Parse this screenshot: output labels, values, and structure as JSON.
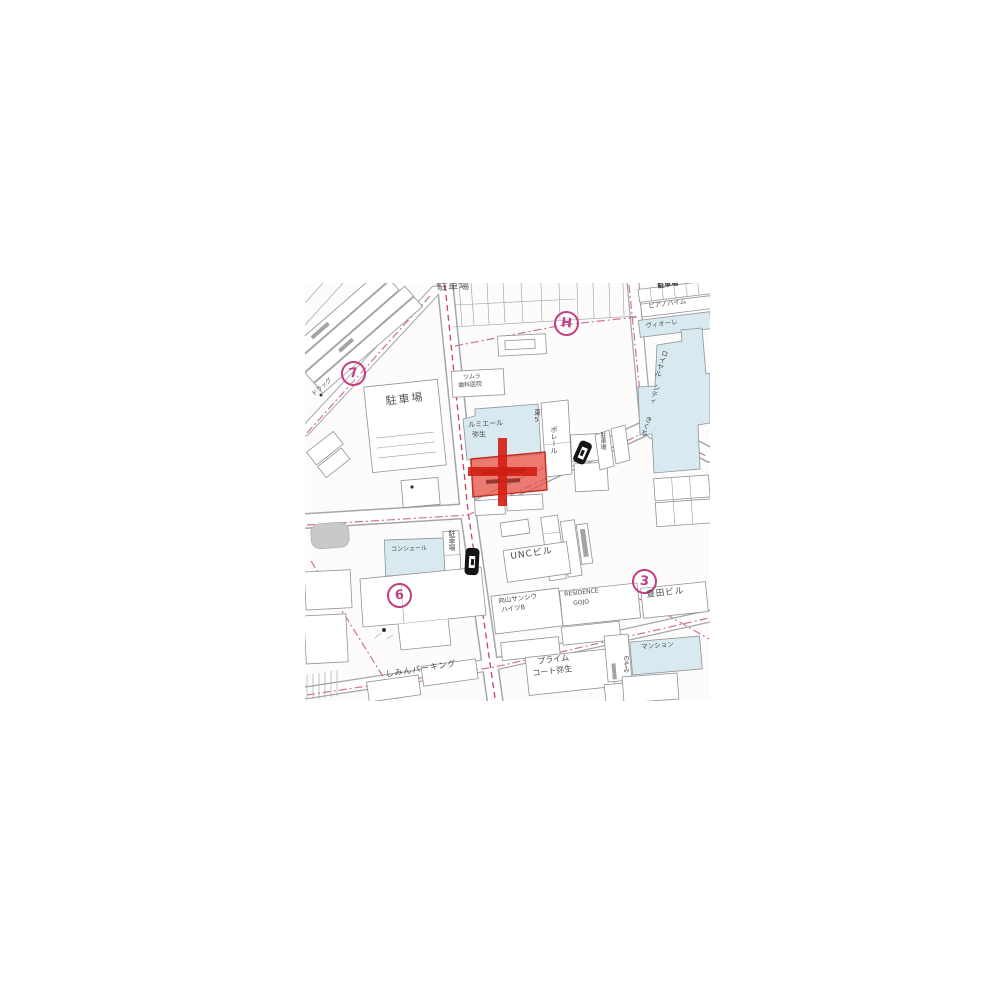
{
  "map": {
    "type": "japanese-residential-map",
    "markers": {
      "seven": "7",
      "h": "H",
      "six": "6",
      "three": "3"
    },
    "labels": {
      "parking_top": "駐車場",
      "parking_corner": "駐車場",
      "parking_left": "駐車場",
      "parking_vertical_1": "駐車場",
      "parking_vertical_2": "駐車場",
      "dental_line1": "ツムラ",
      "dental_line2": "歯科医院",
      "lumiere_line1": "ルミエール",
      "lumiere_line2": "弥生",
      "higashi5": "東5",
      "poreru": "ポレール",
      "piano_heim": "ピアノハイム",
      "viore": "ヴィオーレ",
      "royal_line1": "ロイヤル",
      "royal_line2": "シティ",
      "royal_line3": "きくち",
      "unc_building": "UNCビル",
      "haitsu_line1": "向山サンシウ",
      "haitsu_line2": "ハイツB",
      "residence_line1": "RESIDENCE",
      "residence_line2": "GOJO",
      "toyoda_building": "豊田ビル",
      "mansion": "マンション",
      "nozomi": "のぞみ",
      "prime_line1": "プライム",
      "prime_line2": "コート弥生",
      "shimin_parking": "しみんパーキング",
      "conciere": "コンシェール",
      "drug": "ドラッグ"
    },
    "colors": {
      "highlight_parcel": "#e8554a",
      "highlight_cross": "#d21e12",
      "marker_magenta": "#c23d82",
      "building_blue": "#d9e9f0",
      "parcel_line": "#8e9296",
      "road_center_dash": "#cc4455",
      "boundary_dash": "#cf6f9a",
      "label_text": "#4a4a4a"
    }
  }
}
